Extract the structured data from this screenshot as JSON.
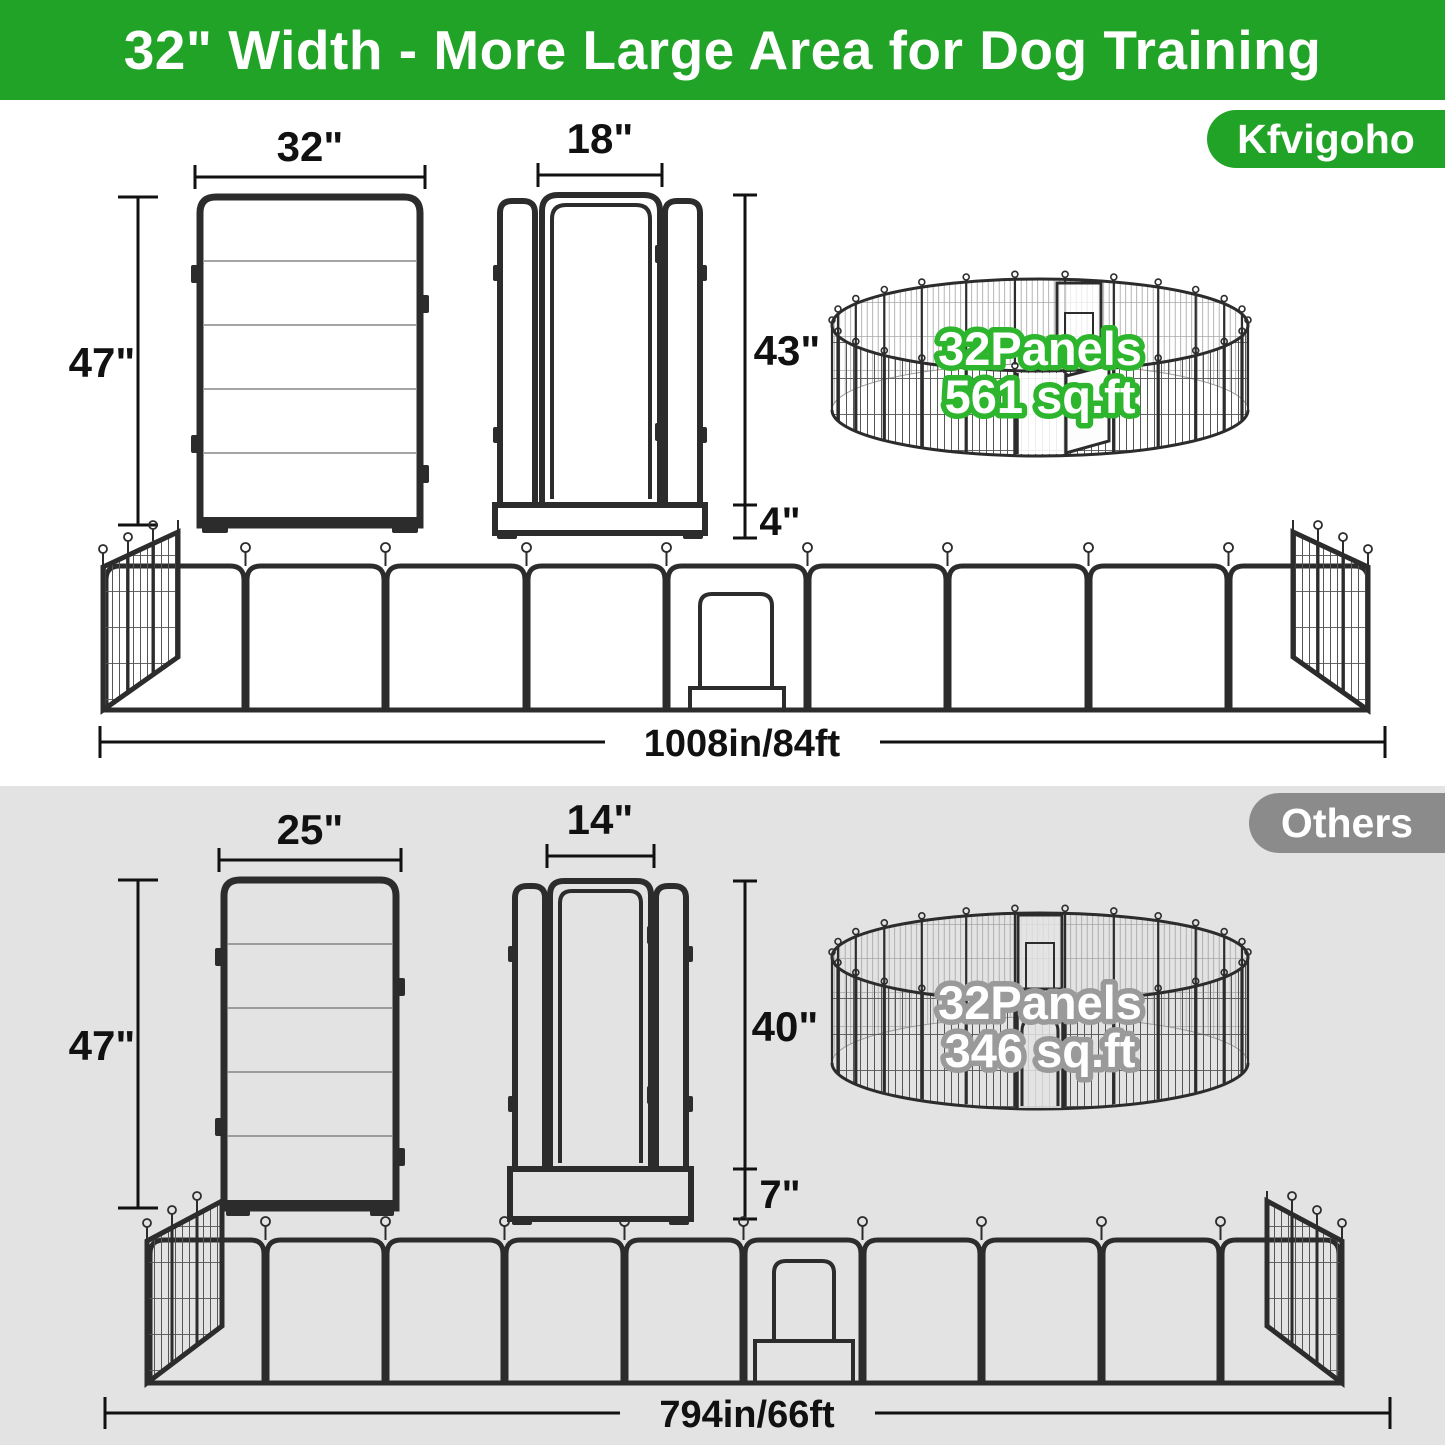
{
  "banner": {
    "title": "32\" Width - More Large Area for Dog Training"
  },
  "colors": {
    "banner_green": "#21a327",
    "brand_badge_green": "#21a327",
    "others_badge_gray": "#8b8b8b",
    "others_section_gray": "#e3e3e3",
    "pen_label_outline_green": "#2db52d",
    "pen_label_outline_gray": "#9a9a9a",
    "fence_frame_dark": "#2c2c2c"
  },
  "brand": {
    "badge": "Kfvigoho",
    "panel": {
      "width": "32\"",
      "height": "47\""
    },
    "door": {
      "width": "18\"",
      "height": "43\"",
      "base": "4\""
    },
    "pen": {
      "panels": "32Panels",
      "area": "561 sq.ft"
    },
    "row": {
      "length": "1008in/84ft"
    }
  },
  "others": {
    "badge": "Others",
    "panel": {
      "width": "25\"",
      "height": "47\""
    },
    "door": {
      "width": "14\"",
      "height": "40\"",
      "base": "7\""
    },
    "pen": {
      "panels": "32Panels",
      "area": "346 sq.ft"
    },
    "row": {
      "length": "794in/66ft"
    }
  }
}
